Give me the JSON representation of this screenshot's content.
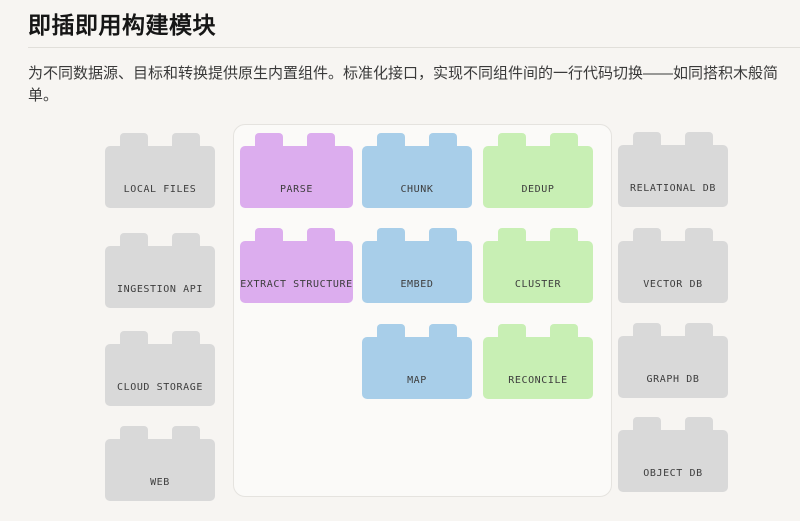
{
  "header": {
    "title": "即插即用构建模块"
  },
  "intro": {
    "text": "为不同数据源、目标和转换提供原生内置组件。标准化接口，实现不同组件间的一行代码切换——如同搭积木般简单。"
  },
  "colors": {
    "page_background": "#f7f5f2",
    "panel_background": "#fbfaf8",
    "panel_border": "#e5e3df",
    "source_color": "#d9d9d9",
    "target_color": "#d9d9d9"
  },
  "diagram": {
    "source_blocks": [
      {
        "label": "LOCAL FILES"
      },
      {
        "label": "INGESTION API"
      },
      {
        "label": "CLOUD STORAGE"
      },
      {
        "label": "WEB"
      }
    ],
    "transform_columns": [
      {
        "name": "parse-column",
        "color": "#dcadee",
        "blocks": [
          {
            "label": "PARSE"
          },
          {
            "label": "EXTRACT STRUCTURE"
          }
        ]
      },
      {
        "name": "chunk-column",
        "color": "#a8cee9",
        "blocks": [
          {
            "label": "CHUNK"
          },
          {
            "label": "EMBED"
          },
          {
            "label": "MAP"
          }
        ]
      },
      {
        "name": "dedup-column",
        "color": "#c8efb4",
        "blocks": [
          {
            "label": "DEDUP"
          },
          {
            "label": "CLUSTER"
          },
          {
            "label": "RECONCILE"
          }
        ]
      }
    ],
    "target_blocks": [
      {
        "label": "RELATIONAL DB"
      },
      {
        "label": "VECTOR DB"
      },
      {
        "label": "GRAPH DB"
      },
      {
        "label": "OBJECT DB"
      }
    ]
  }
}
